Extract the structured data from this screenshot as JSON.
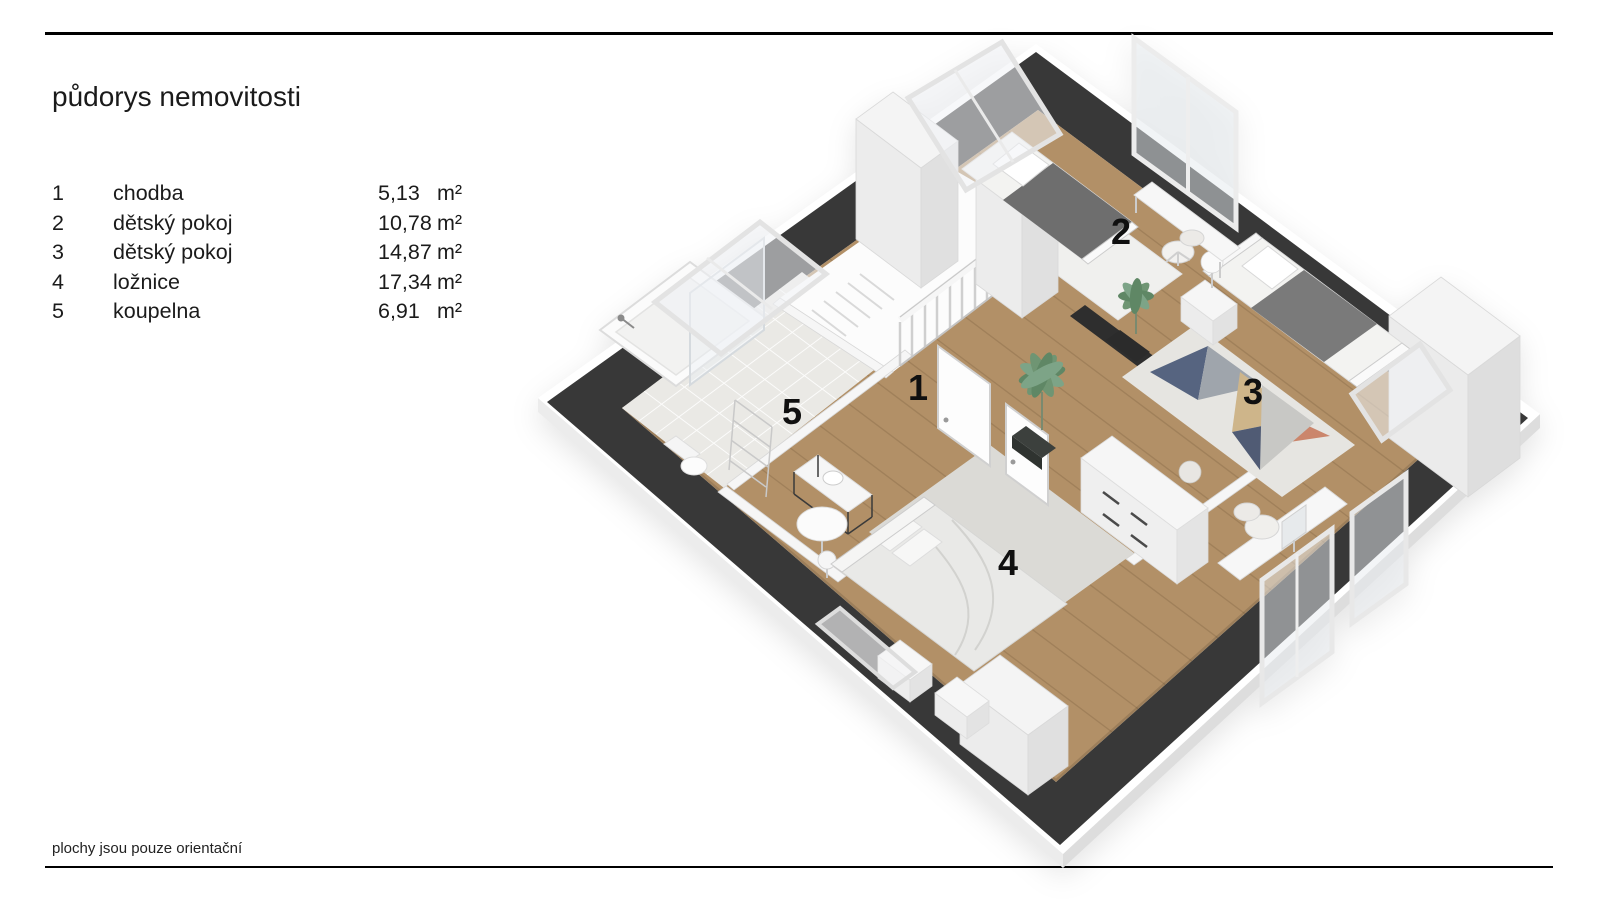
{
  "header": {
    "title": "půdorys nemovitosti"
  },
  "legend": {
    "rows": [
      {
        "num": "1",
        "name": "chodba",
        "area": "5,13",
        "unit": "m²"
      },
      {
        "num": "2",
        "name": "dětský pokoj",
        "area": "10,78",
        "unit": "m²"
      },
      {
        "num": "3",
        "name": "dětský pokoj",
        "area": "14,87",
        "unit": "m²"
      },
      {
        "num": "4",
        "name": "ložnice",
        "area": "17,34",
        "unit": "m²"
      },
      {
        "num": "5",
        "name": "koupelna",
        "area": "6,91",
        "unit": "m²"
      }
    ]
  },
  "plan": {
    "labels": [
      {
        "num": "1",
        "name": "chodba"
      },
      {
        "num": "2",
        "name": "dětský pokoj"
      },
      {
        "num": "3",
        "name": "dětský pokoj"
      },
      {
        "num": "4",
        "name": "ložnice"
      },
      {
        "num": "5",
        "name": "koupelna"
      }
    ]
  },
  "footer": {
    "note": "plochy jsou pouze orientační"
  },
  "colors": {
    "wall_band": "#383838",
    "wood_floor": "#b29067",
    "tile_floor": "#eae9e5",
    "rug_navy": "#4a5a78",
    "rug_salmon": "#c97f63",
    "rug_tan": "#ccb183",
    "plant_green": "#6f9573"
  }
}
